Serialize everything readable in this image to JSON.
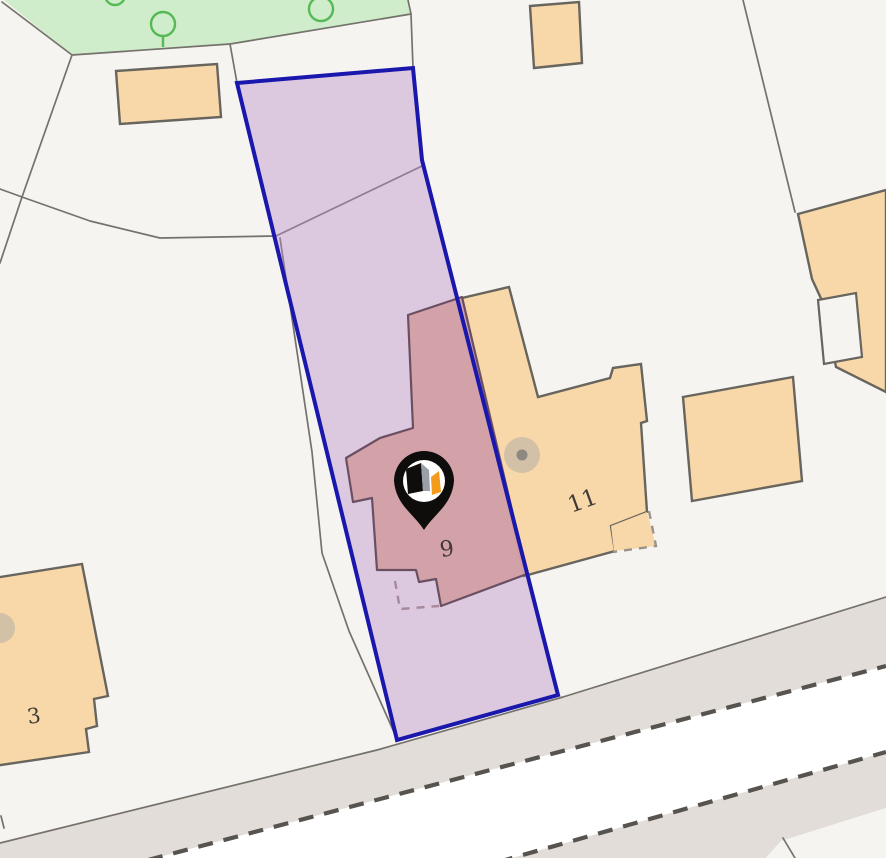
{
  "map": {
    "labels": {
      "subject_house_number": "9",
      "right_neighbour_house_number": "11",
      "left_neighbour_house_number": "3"
    },
    "marker": {
      "icon": "house-pin"
    },
    "colors": {
      "background": "#f6f4f0",
      "grass": "#cfeccb",
      "tree_outline": "#55b955",
      "building_fill": "#f8d8a8",
      "building_border": "#68645e",
      "parcel_line": "#75716b",
      "road_fill": "#e2ddd8",
      "road_center": "#ffffff",
      "road_dash": "#57534e",
      "plot_fill": "#b78cc9",
      "plot_border": "#1a17ad",
      "subject_fill": "#d2a0a4",
      "subject_border": "#6a4f63",
      "label_color": "#3f3a35",
      "pin_black": "#0e0d0b",
      "pin_orange": "#f39c1c",
      "tree_dot_fill": "#b3ada5",
      "tree_dot_center": "#8d8981"
    }
  }
}
